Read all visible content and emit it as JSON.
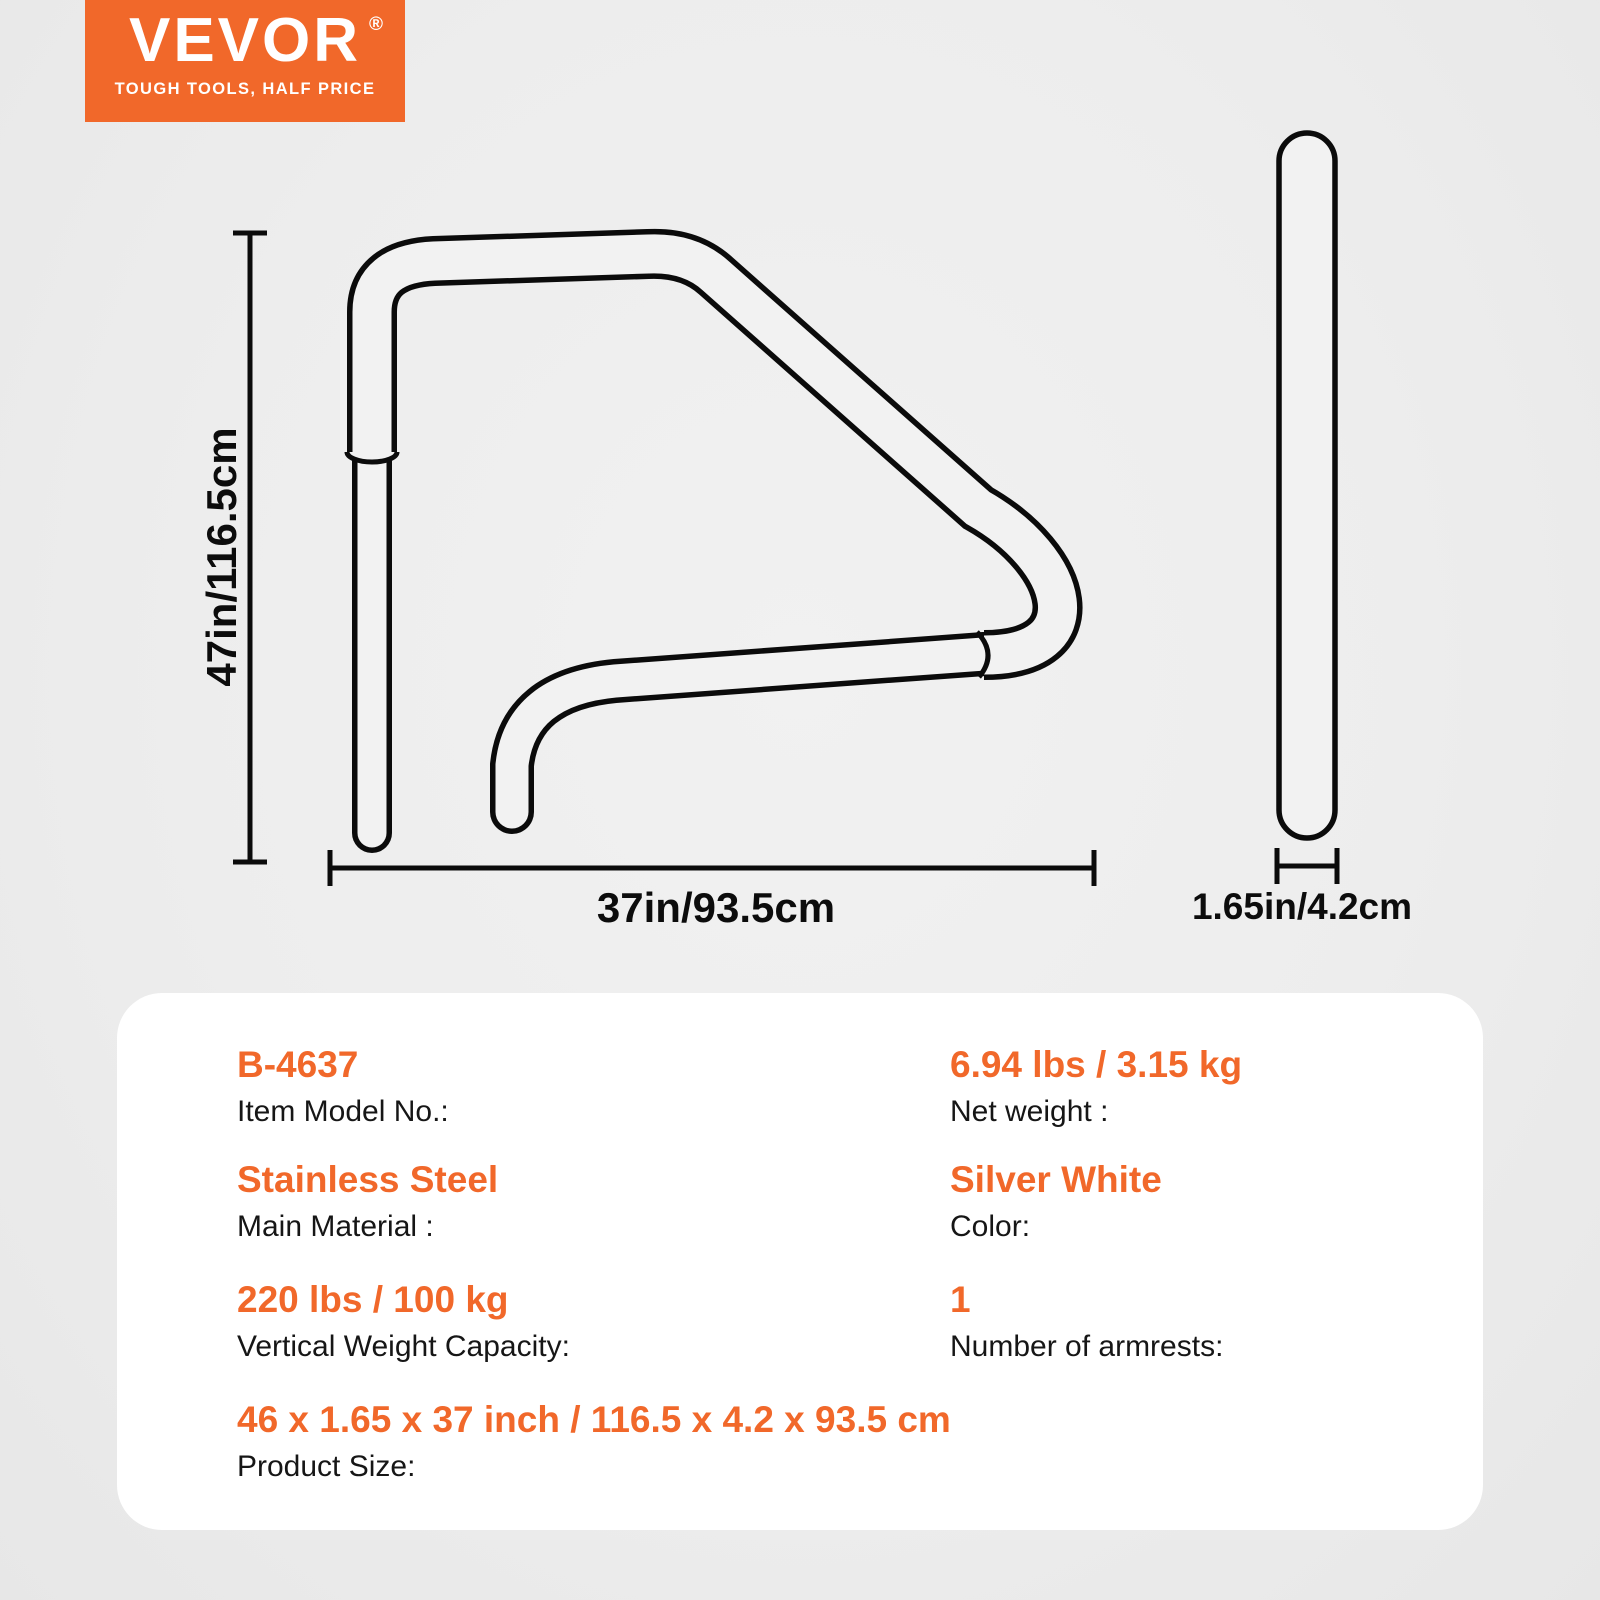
{
  "brand": {
    "logo_text": "VEVOR",
    "registered_mark": "®",
    "tagline": "TOUGH TOOLS, HALF PRICE",
    "brand_color": "#f1682a"
  },
  "diagram": {
    "front_view": {
      "height_label": "47in/116.5cm",
      "width_label": "37in/93.5cm"
    },
    "side_view": {
      "width_label": "1.65in/4.2cm"
    },
    "line_color": "#0b0b0b"
  },
  "specs": {
    "rows": [
      {
        "value": "B-4637",
        "label": "Item Model No.:"
      },
      {
        "value": "6.94 lbs / 3.15 kg",
        "label": "Net weight :"
      },
      {
        "value": "Stainless Steel",
        "label": "Main Material :"
      },
      {
        "value": "Silver White",
        "label": "Color:"
      },
      {
        "value": "220 lbs / 100 kg",
        "label": "Vertical Weight Capacity:"
      },
      {
        "value": "1",
        "label": "Number of armrests:"
      },
      {
        "value": "46 x 1.65 x 37 inch / 116.5 x 4.2 x 93.5 cm",
        "label": "Product Size:"
      }
    ]
  },
  "colors": {
    "background": "#ededed",
    "panel": "#ffffff",
    "accent": "#f1682a",
    "text": "#161616"
  }
}
